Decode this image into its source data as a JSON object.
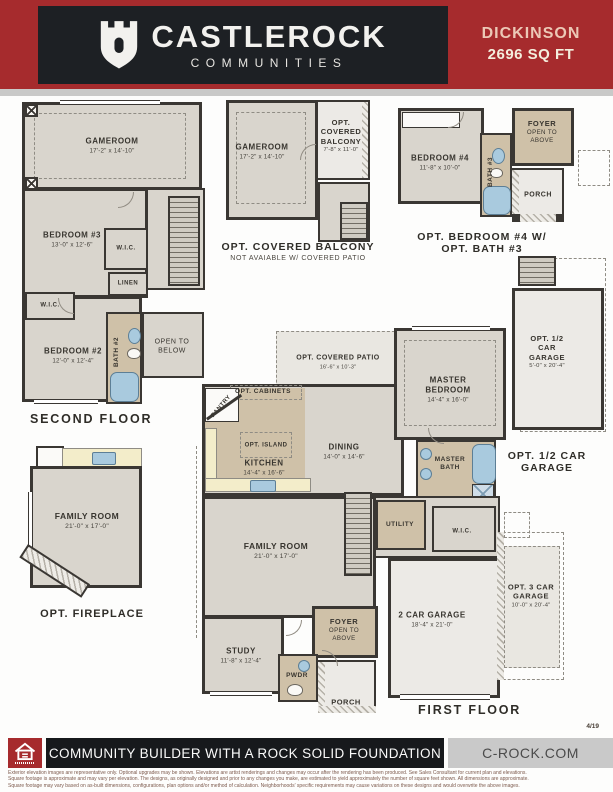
{
  "header": {
    "brand": "CASTLEROCK",
    "brand_sub": "COMMUNITIES",
    "plan_name": "DICKINSON",
    "plan_sqft": "2696 SQ FT"
  },
  "colors": {
    "brand_red": "#a62b2d",
    "brand_dark": "#1d2024",
    "plan_name_text": "#ecc8b6",
    "room_gray": "#d9d5cd",
    "room_tan": "#cfc1a8",
    "counter_yellow": "#f3edca",
    "fixture_blue": "#a9cade",
    "wall": "#3a3733"
  },
  "plans": {
    "second_floor": {
      "caption": "SECOND FLOOR",
      "gameroom": {
        "name": "GAMEROOM",
        "dims": "17'-2\" x 14'-10\""
      },
      "bedroom3": {
        "name": "BEDROOM #3",
        "dims": "13'-0\" x 12'-6\""
      },
      "wic_a": {
        "name": "W.I.C."
      },
      "linen": {
        "name": "LINEN"
      },
      "wic_b": {
        "name": "W.I.C."
      },
      "bedroom2": {
        "name": "BEDROOM #2",
        "dims": "12'-0\" x 12'-4\""
      },
      "bath2": {
        "name": "BATH #2"
      },
      "open_below": {
        "name": "OPEN TO BELOW"
      }
    },
    "opt_balcony": {
      "caption": "OPT. COVERED BALCONY",
      "subcaption": "NOT AVAIABLE W/ COVERED PATIO",
      "gameroom": {
        "name": "GAMEROOM",
        "dims": "17'-2\" x 14'-10\""
      },
      "balcony": {
        "name": "OPT. COVERED BALCONY",
        "dims": "7'-8\" x 11'-0\""
      }
    },
    "opt_bedroom4": {
      "caption": "OPT. BEDROOM #4 W/ OPT. BATH #3",
      "bedroom4": {
        "name": "BEDROOM #4",
        "dims": "11'-8\" x 10'-0\""
      },
      "bath3": {
        "name": "BATH #3"
      },
      "foyer": {
        "name": "FOYER",
        "sub": "OPEN TO ABOVE"
      },
      "porch": {
        "name": "PORCH"
      }
    },
    "first_floor": {
      "caption": "FIRST FLOOR",
      "patio": {
        "name": "OPT. COVERED PATIO",
        "dims": "16'-6\" x 10'-3\""
      },
      "master_bedroom": {
        "name": "MASTER BEDROOM",
        "dims": "14'-4\" x 16'-0\""
      },
      "master_bath": {
        "name": "MASTER BATH"
      },
      "opt_cabinets": {
        "name": "OPT. CABINETS"
      },
      "pantry": {
        "name": "PANTRY"
      },
      "opt_island": {
        "name": "OPT. ISLAND"
      },
      "kitchen": {
        "name": "KITCHEN",
        "dims": "14'-4\" x 16'-6\""
      },
      "dining": {
        "name": "DINING",
        "dims": "14'-0\" x 14'-6\""
      },
      "utility": {
        "name": "UTILITY"
      },
      "wic": {
        "name": "W.I.C."
      },
      "family_room": {
        "name": "FAMILY ROOM",
        "dims": "21'-0\" x 17'-0\""
      },
      "study": {
        "name": "STUDY",
        "dims": "11'-8\" x 12'-4\""
      },
      "foyer": {
        "name": "FOYER",
        "sub": "OPEN TO ABOVE"
      },
      "pwdr": {
        "name": "PWDR"
      },
      "porch": {
        "name": "PORCH"
      },
      "garage2": {
        "name": "2 CAR GARAGE",
        "dims": "18'-4\" x 21'-0\""
      }
    },
    "opt_fireplace": {
      "caption": "OPT. FIREPLACE",
      "family_room": {
        "name": "FAMILY ROOM",
        "dims": "21'-0\" x 17'-0\""
      }
    },
    "opt_half_garage": {
      "caption": "OPT. 1/2 CAR GARAGE",
      "label": {
        "name": "OPT. 1/2 CAR GARAGE",
        "dims": "5'-0\" x 20'-4\""
      }
    },
    "opt_3car_garage": {
      "label": {
        "name": "OPT. 3 CAR GARAGE",
        "dims": "10'-0\" x 20'-4\""
      }
    }
  },
  "footer": {
    "page_ref": "4/19",
    "tagline": "COMMUNITY BUILDER WITH A ROCK SOLID FOUNDATION",
    "website": "C-ROCK.COM",
    "disclaimer": [
      "Exterior elevation images are representative only. Optional upgrades may be shown. Elevations are artist renderings and changes may occur after the rendering has been produced. See Sales Consultant for current plan and elevations.",
      "Square footage is approximate and may vary per elevation. The designs, as originally designed and prior to any changes you make, are estimated to yield approximately the number of square feet shown. All dimensions are approximate.",
      "Square footage may vary based on as-built dimensions, configurations, plan options and/or method of calculation. Neighborhoods' specific requirements may cause variations on these designs and would overwrite the above images."
    ]
  }
}
